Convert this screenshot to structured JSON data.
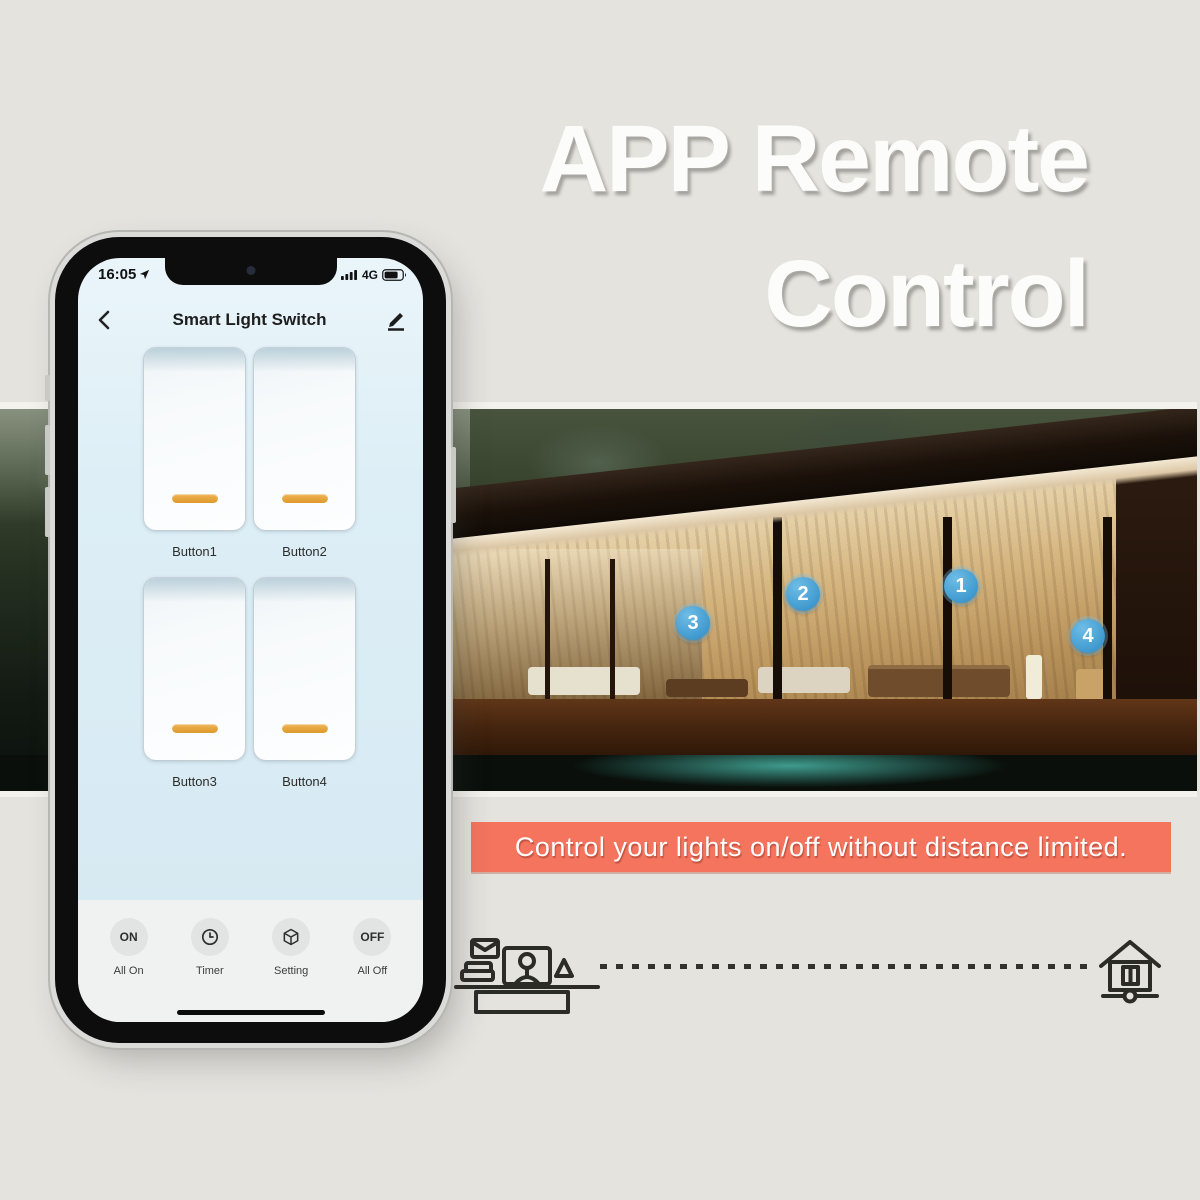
{
  "hero": {
    "line1": "APP Remote",
    "line2": "Control"
  },
  "banner": {
    "text": "Control your lights on/off without distance limited.",
    "background": "#f4745e"
  },
  "photo": {
    "badges": [
      "1",
      "2",
      "3",
      "4"
    ],
    "badge_color": "#3d97cd"
  },
  "phone": {
    "status": {
      "time": "16:05",
      "network": "4G"
    },
    "header": {
      "title": "Smart Light Switch"
    },
    "switches": [
      {
        "label": "Button1"
      },
      {
        "label": "Button2"
      },
      {
        "label": "Button3"
      },
      {
        "label": "Button4"
      }
    ],
    "toolbar": [
      {
        "icon_text": "ON",
        "label": "All On"
      },
      {
        "icon_text": "",
        "label": "Timer"
      },
      {
        "icon_text": "",
        "label": "Setting"
      },
      {
        "icon_text": "OFF",
        "label": "All Off"
      }
    ],
    "indicator_color": "#dd9a2c"
  }
}
